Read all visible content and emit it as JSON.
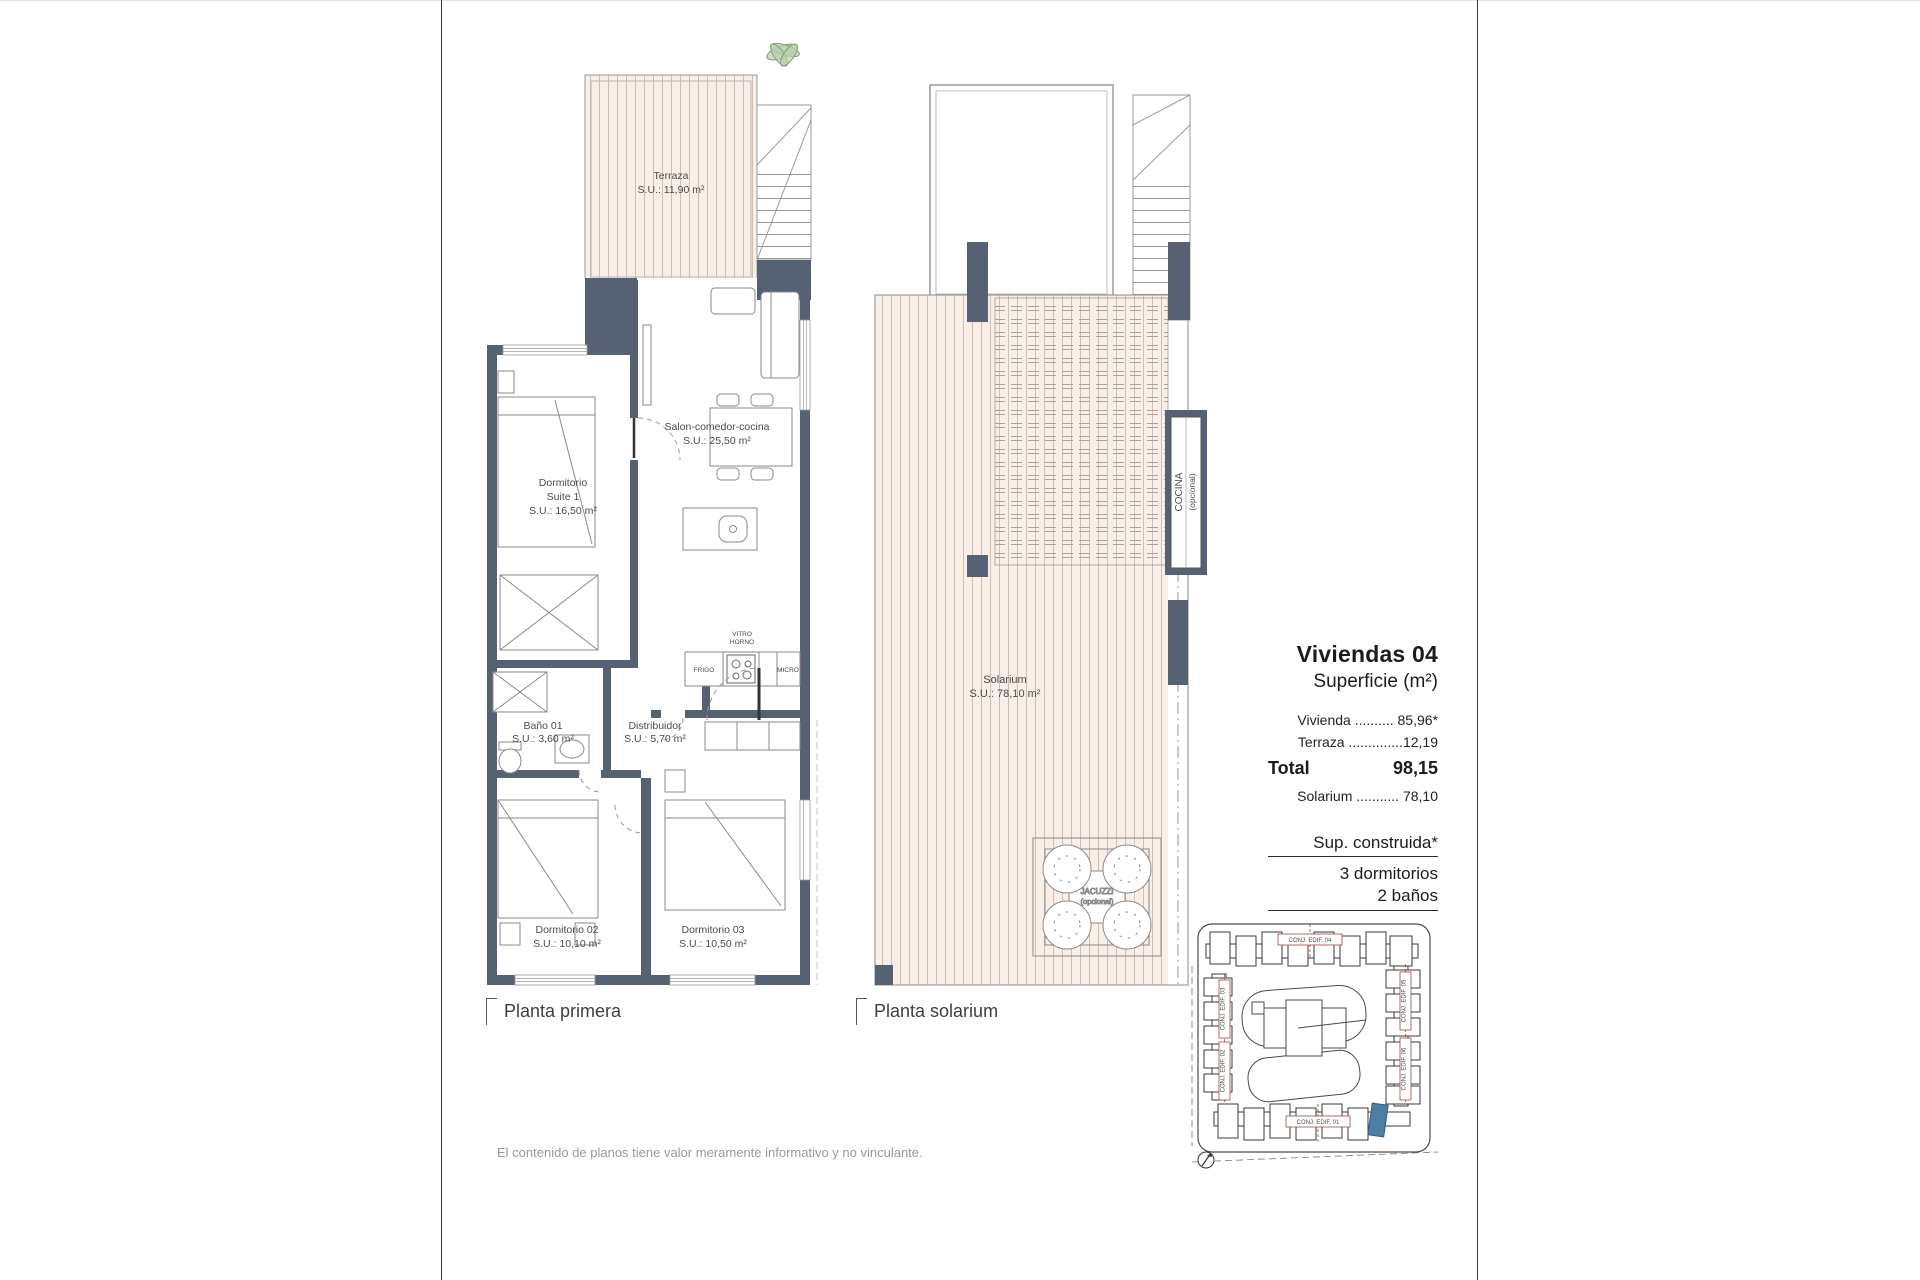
{
  "plan1": {
    "caption": "Planta primera",
    "terraza_name": "Terraza",
    "terraza_area": "S.U.: 11,90 m²",
    "suite_l1": "Dormitorio",
    "suite_l2": "Suite 1",
    "suite_area": "S.U.: 16,50 m²",
    "salon_name": "Salon-comedor-cocina",
    "salon_area": "S.U.: 25,50 m²",
    "bano_name": "Baño 01",
    "bano_area": "S.U.: 3,60 m²",
    "distribuidor_name": "Distribuidor",
    "distribuidor_area": "S.U.: 5,70 m²",
    "dorm2_name": "Dormitorio 02",
    "dorm2_area": "S.U.: 10,10 m²",
    "dorm3_name": "Dormitorio 03",
    "dorm3_area": "S.U.: 10,50 m²",
    "kitchen_vitro_l1": "VITRO",
    "kitchen_vitro_l2": "HORNO",
    "kitchen_frigo": "FRIGO",
    "kitchen_micro": "MICRO"
  },
  "plan2": {
    "caption": "Planta solarium",
    "solarium_name": "Solarium",
    "solarium_area": "S.U.: 78,10 m²",
    "cocina_l1": "COCINA",
    "cocina_l2": "(opcional)",
    "jacuzzi_l1": "JACUZZI",
    "jacuzzi_l2": "(opcional)"
  },
  "info": {
    "title": "Viviendas 04",
    "subtitle": "Superficie (m²)",
    "rows": [
      {
        "label": "Vivienda",
        "dots": "..........",
        "value": "85,96*"
      },
      {
        "label": "Terraza",
        "dots": "..............",
        "value": "12,19"
      }
    ],
    "total_label": "Total",
    "total_value": "98,15",
    "solarium_row": {
      "label": "Solarium",
      "dots": "...........",
      "value": "78,10"
    },
    "construida": "Sup. construida*",
    "bedrooms": "3 dormitorios",
    "baths": "2 baños"
  },
  "sitemap": {
    "edif01": "CONJ. EDIF. 01",
    "edif02": "CONJ. EDIF. 02",
    "edif03": "CONJ. EDIF. 03",
    "edif04": "CONJ. EDIF. 04",
    "edif05": "CONJ. EDIF. 05",
    "edif06": "CONJ. EDIF. 06"
  },
  "footer": {
    "disclaimer": "El contenido de planos tiene valor meramente informativo y no vinculante."
  },
  "colors": {
    "wall": "#566274",
    "stripe_bg": "#f8efe9",
    "stripe_line": "#d3bdb2",
    "highlight_blue": "#4e7da4",
    "label_red": "#a14a42"
  }
}
